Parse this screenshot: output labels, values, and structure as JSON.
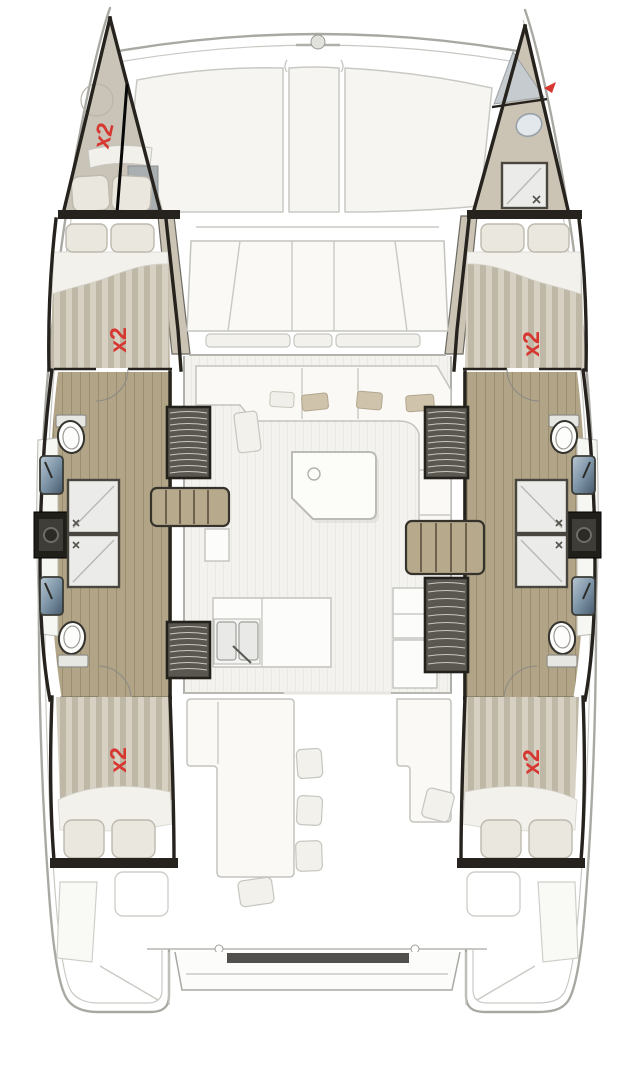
{
  "plan": {
    "labels": {
      "port_forepeak": "x2",
      "port_forward_cabin": "x2",
      "port_aft_cabin": "x2",
      "starboard_forward_cabin": "x2",
      "starboard_aft_cabin": "x2"
    },
    "colors": {
      "red_label": "#d63730",
      "wall_dark": "#26231e",
      "wood_floor": "#b1a487",
      "wood_line": "#9a8d70",
      "berth_beige": "#c9c4b7",
      "stripe_light": "#d7d1c3",
      "stripe_dark": "#c0b8a6",
      "pillow": "#eae7de",
      "deck_line": "#a9a9a3",
      "light_line": "#c9c9c4",
      "panel_fill": "#f6f5f1",
      "floor_fill": "#f3f2ee",
      "shower_fill": "#ebebe9",
      "louver_dark": "#5a5751",
      "white": "#ffffff"
    }
  }
}
